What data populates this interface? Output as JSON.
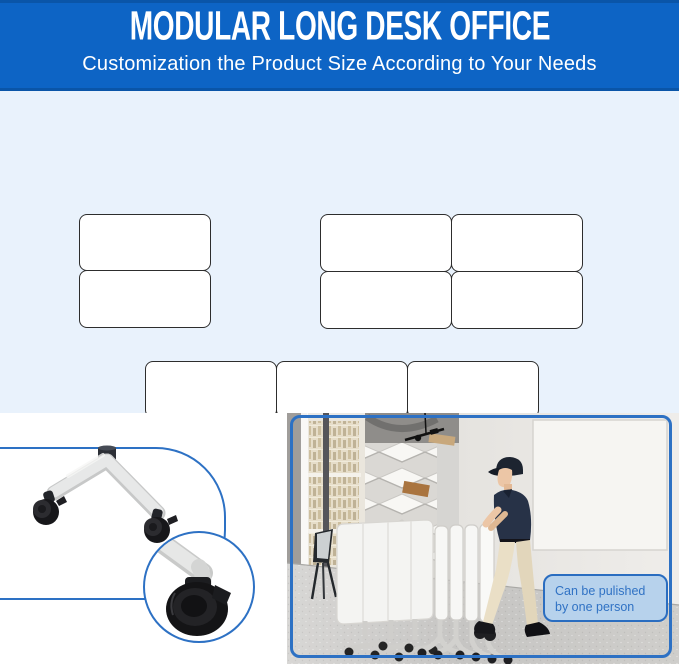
{
  "banner": {
    "title": "MODULAR LONG DESK OFFICE",
    "subtitle": "Customization the Product Size According to Your Needs"
  },
  "desk_configurations": {
    "items": [
      {
        "name": "double-desk-row",
        "cols": 1,
        "rows": 2,
        "desk_count": 2
      },
      {
        "name": "four-desk-grid",
        "cols": 2,
        "rows": 2,
        "desk_count": 4
      },
      {
        "name": "six-desk-grid",
        "cols": 3,
        "rows": 2,
        "desk_count": 6
      }
    ]
  },
  "illustrations": {
    "leg": "desk-leg-with-caster-wheels",
    "zoom_detail": "lockable-caster-wheel-close-up",
    "photo": "person-pushing-folded-flip-top-desks"
  },
  "photo": {
    "caption": "Can be pulished by one person"
  },
  "colors": {
    "banner_bg": "#0d64c5",
    "banner_edge": "#0a55a8",
    "section_bg": "#e9f2fc",
    "accent_outline": "#2d71c4",
    "caption_bg": "#b7d2ec",
    "caption_border": "#2a6dc0",
    "caption_text": "#3072c4"
  }
}
